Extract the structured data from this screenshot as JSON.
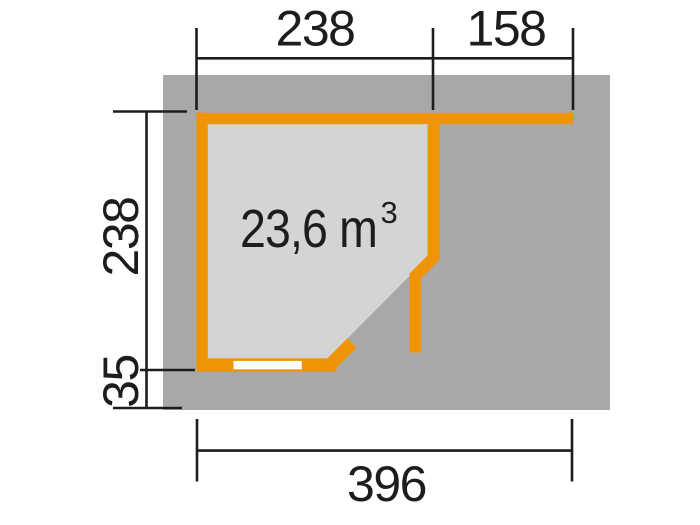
{
  "plan": {
    "volume_label": {
      "main": "23,6 m",
      "superscript": "3"
    },
    "dimensions": {
      "top_width": "238",
      "top_right_width": "158",
      "left_height": "238",
      "left_overhang": "35",
      "bottom_total_width": "396"
    },
    "colors": {
      "wall_orange": "#EE9405",
      "base_gray": "#A8A8A8",
      "floor_gray": "#D4D4D4",
      "door_white": "#FFFFFF",
      "dimension_black": "#1D1D1D",
      "page_background": "#FFFFFF"
    }
  }
}
